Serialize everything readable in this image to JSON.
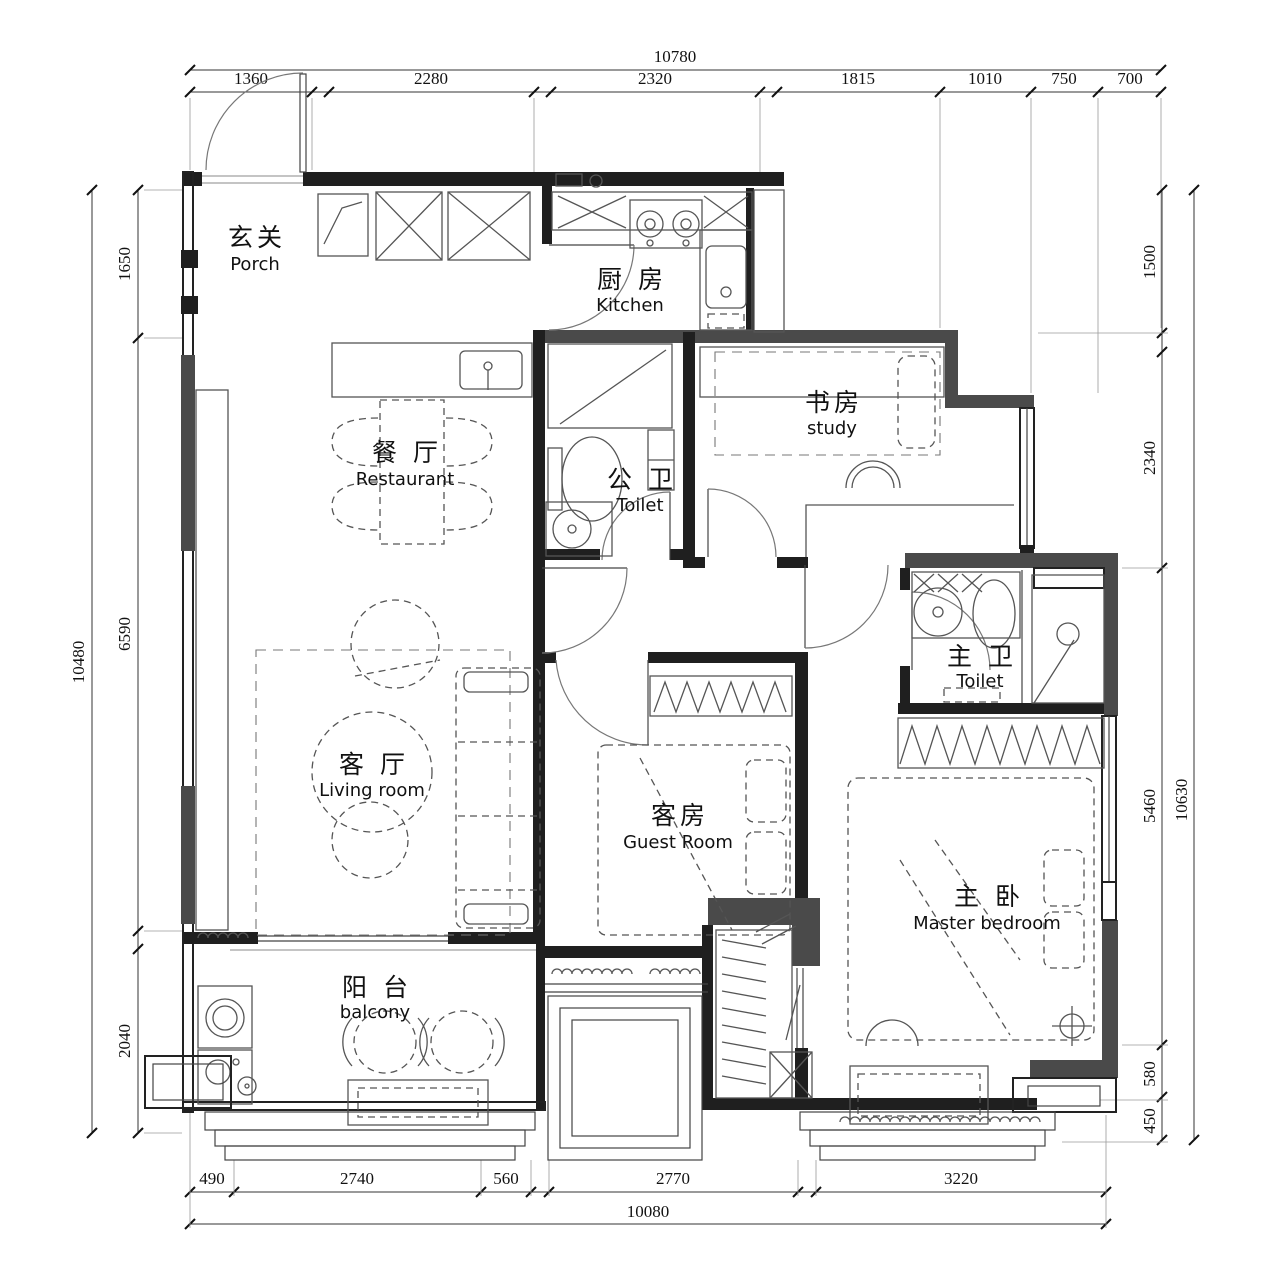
{
  "drawing": {
    "kind": "residential floor plan",
    "wall_color": "#4a4a4a",
    "line_color": "#1f1f1f",
    "background": "#ffffff"
  },
  "rooms": {
    "porch": {
      "cn": "玄关",
      "en": "Porch"
    },
    "kitchen": {
      "cn": "厨 房",
      "en": "Kitchen"
    },
    "dining": {
      "cn": "餐 厅",
      "en": "Restaurant"
    },
    "study": {
      "cn": "书房",
      "en": "study"
    },
    "public_toilet": {
      "cn": "公 卫",
      "en": "Toilet"
    },
    "living": {
      "cn": "客 厅",
      "en": "Living room"
    },
    "guest": {
      "cn": "客房",
      "en": "Guest Room"
    },
    "master_toilet": {
      "cn": "主 卫",
      "en": "Toilet"
    },
    "master": {
      "cn": "主 卧",
      "en": "Master bedroom"
    },
    "balcony": {
      "cn": "阳 台",
      "en": "balcony"
    }
  },
  "dimensions": {
    "top": {
      "total": "10780",
      "segments": [
        "1360",
        "2280",
        "2320",
        "1815",
        "1010",
        "750",
        "700"
      ]
    },
    "left": {
      "total": "10480",
      "segments": [
        "1650",
        "6590",
        "2040"
      ]
    },
    "right": {
      "total": "10630",
      "segments": [
        "1500",
        "2340",
        "5460",
        "580",
        "450"
      ]
    },
    "bottom": {
      "total": "10080",
      "segments": [
        "490",
        "2740",
        "560",
        "2770",
        "3220"
      ]
    }
  }
}
